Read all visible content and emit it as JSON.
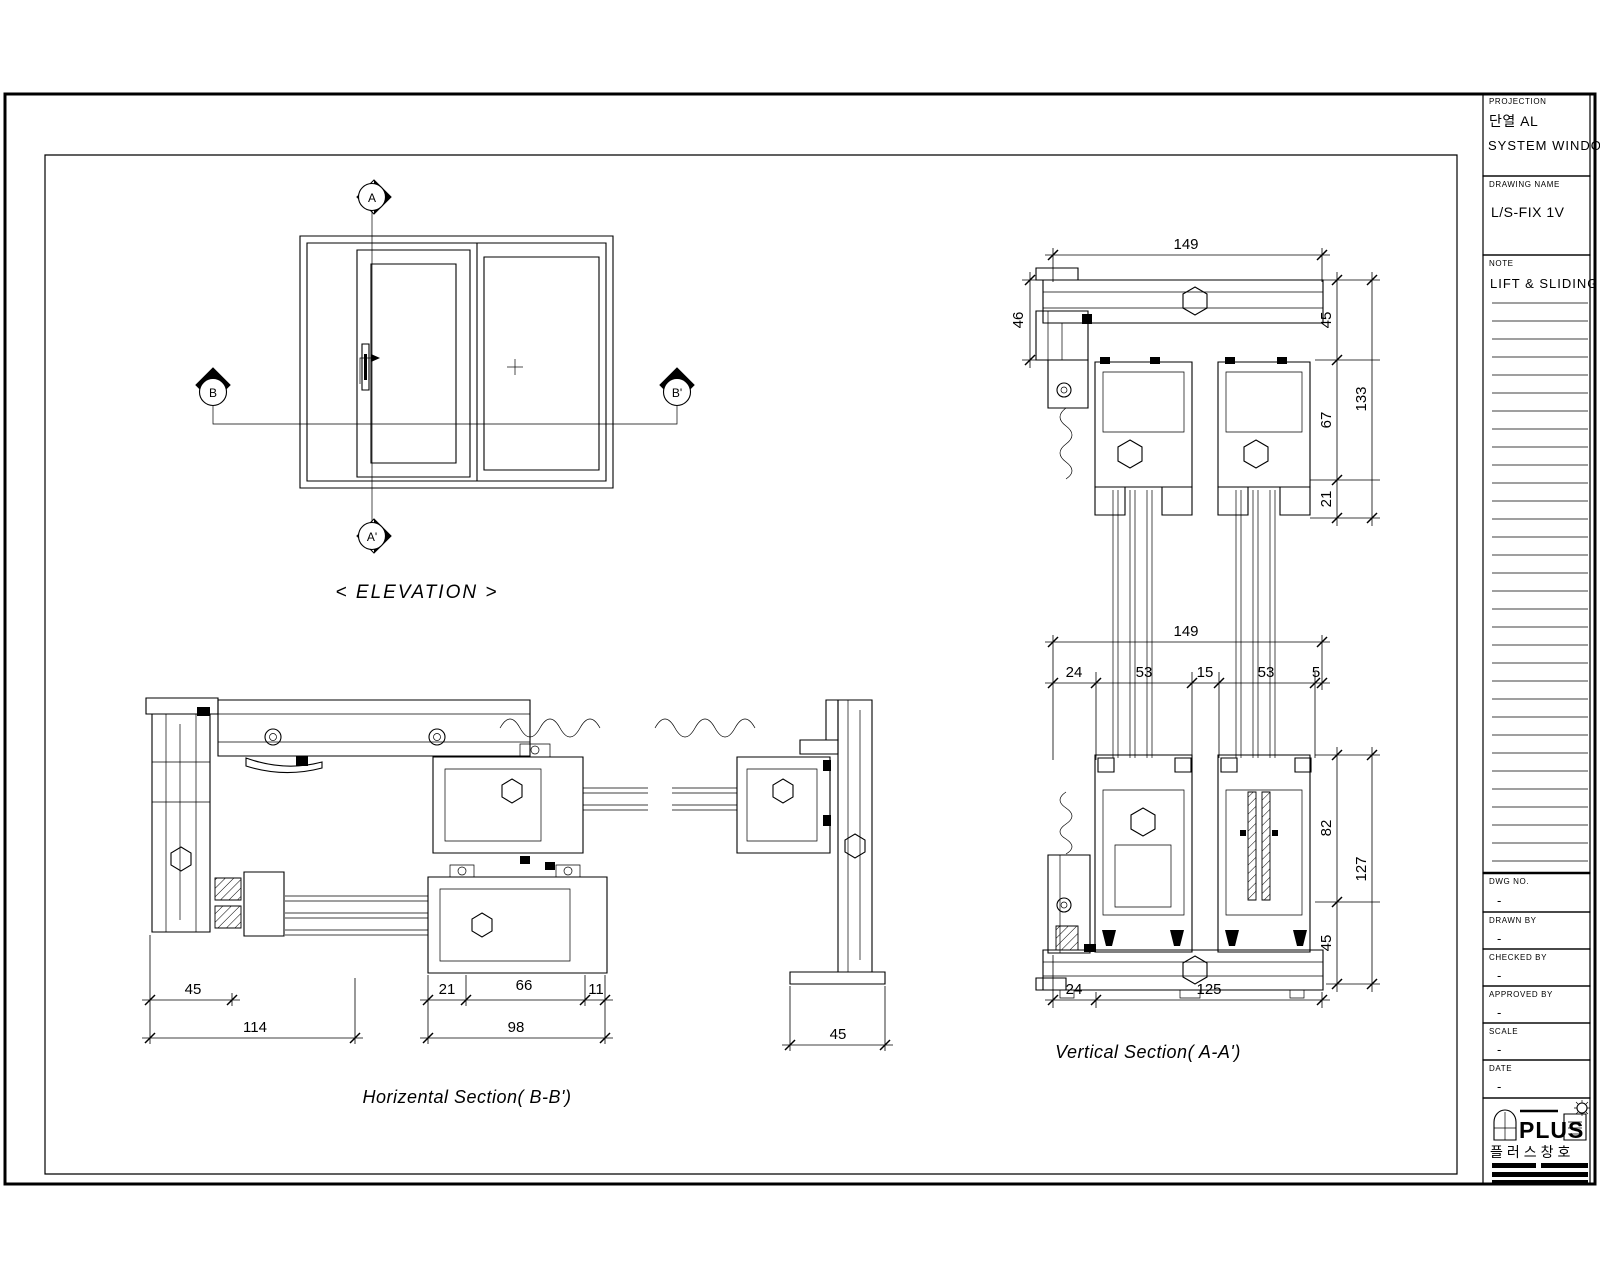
{
  "sheet": {
    "title_block": {
      "projection_label": "PROJECTION",
      "projection_line1": "단열 AL",
      "projection_line2": "SYSTEM WINDOWS",
      "drawing_name_label": "DRAWING NAME",
      "drawing_name": "L/S-FIX 1V",
      "note_label": "NOTE",
      "note": "LIFT & SLIDING",
      "dwg_no_label": "DWG NO.",
      "dwg_no": "-",
      "drawn_by_label": "DRAWN BY",
      "drawn_by": "-",
      "checked_by_label": "CHECKED BY",
      "checked_by": "-",
      "approved_by_label": "APPROVED BY",
      "approved_by": "-",
      "scale_label": "SCALE",
      "scale": "-",
      "date_label": "DATE",
      "date": "-",
      "logo_text": "PLUS",
      "logo_korean": "플러스창호"
    },
    "elevation": {
      "title": "< ELEVATION >",
      "marker_a": "A",
      "marker_a_prime": "A'",
      "marker_b": "B",
      "marker_b_prime": "B'"
    },
    "horizontal_section": {
      "title": "Horizental Section( B-B')",
      "dims": {
        "d45_left": "45",
        "d114": "114",
        "d21": "21",
        "d66": "66",
        "d11": "11",
        "d98": "98",
        "d45_right": "45"
      }
    },
    "vertical_section": {
      "title": "Vertical Section( A-A')",
      "dims": {
        "d149_top": "149",
        "d46": "46",
        "d45_top": "45",
        "d67": "67",
        "d21": "21",
        "d133": "133",
        "d149_mid": "149",
        "d24": "24",
        "d53_a": "53",
        "d15": "15",
        "d53_b": "53",
        "d5": "5",
        "d82": "82",
        "d127": "127",
        "d45_bottom": "45",
        "d24_bottom": "24",
        "d125": "125"
      }
    }
  }
}
